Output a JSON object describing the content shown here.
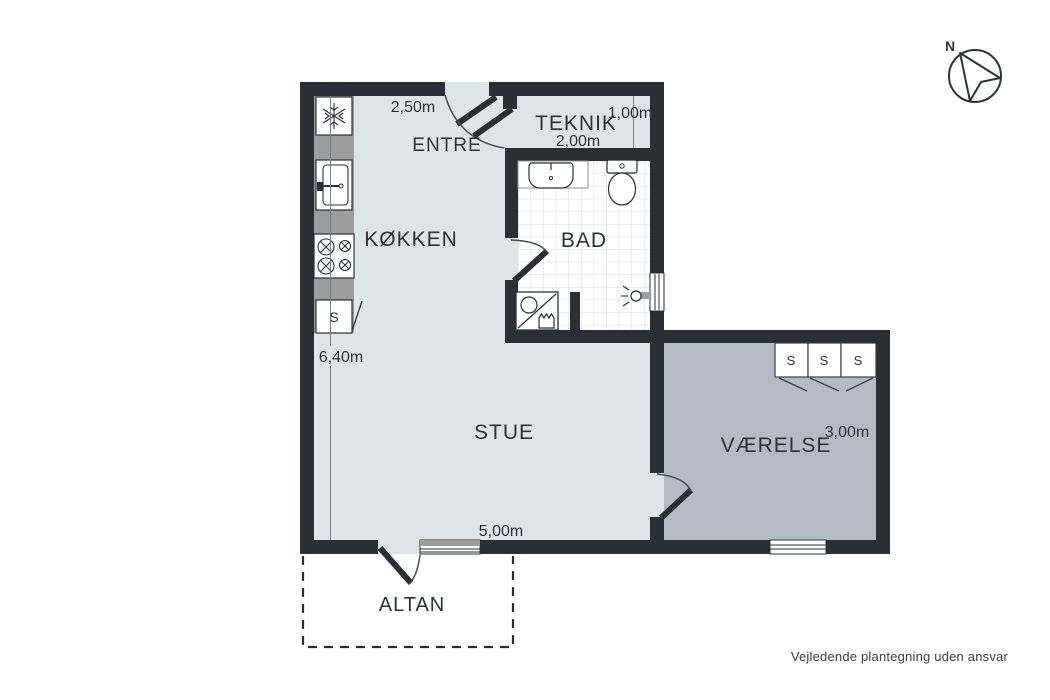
{
  "title": "Floor plan",
  "colors": {
    "wall": "#2b2f35",
    "room_light": "#dfe4e6",
    "room_dark": "#b5bbc5",
    "counter_gray": "#9d9d9d",
    "tile_line": "#d8dadb",
    "text": "#2e3237"
  },
  "rooms": {
    "entre": {
      "name": "ENTRÉ"
    },
    "kokken": {
      "name": "KØKKEN"
    },
    "teknik": {
      "name": "TEKNIK"
    },
    "bad": {
      "name": "BAD"
    },
    "stue": {
      "name": "STUE"
    },
    "vaerelse": {
      "name": "VÆRELSE"
    },
    "altan": {
      "name": "ALTAN"
    }
  },
  "measurements": {
    "kokken_top": "2,50m",
    "kokken_left": "6,40m",
    "teknik_depth": "1,00m",
    "teknik_width": "2,00m",
    "stue_bottom": "5,00m",
    "vaerelse_width": "3,00m"
  },
  "labels": {
    "wardrobe": "S",
    "kitchen_cabinet": "S"
  },
  "compass": {
    "north": "N"
  },
  "footer": {
    "disclaimer": "Vejledende plantegning uden ansvar"
  }
}
